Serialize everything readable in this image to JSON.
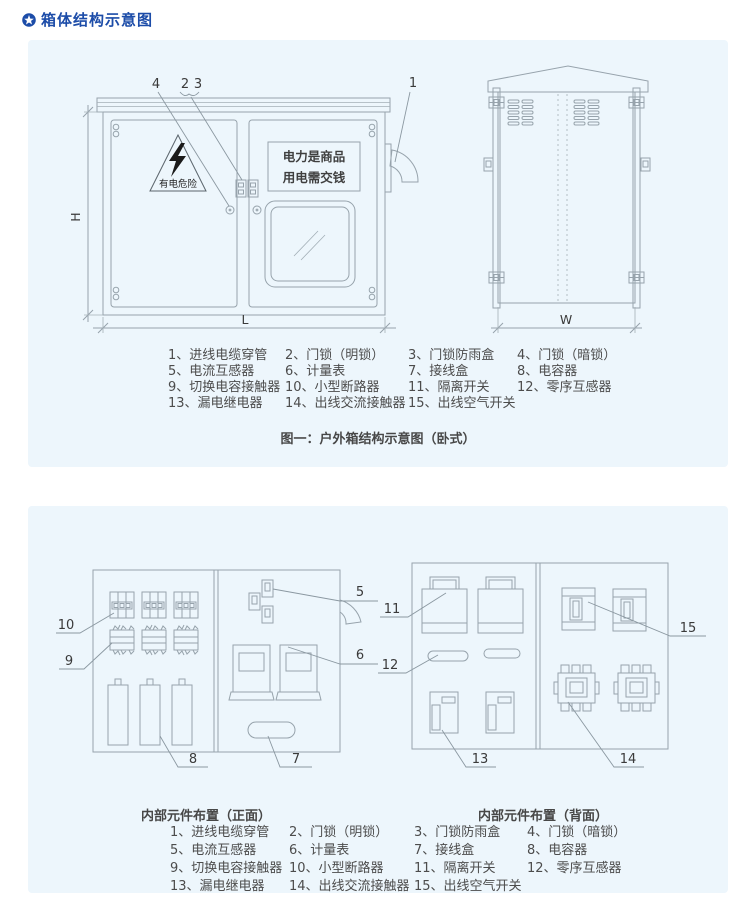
{
  "page": {
    "title": "箱体结构示意图"
  },
  "colors": {
    "accent_blue": "#1c4ca8",
    "panel_bg": "#edf6fc",
    "line_gray": "#97a3ac"
  },
  "figure1": {
    "caption": "图一：户外箱结构示意图（卧式）",
    "warning_text": "有电危险",
    "sign_line1": "电力是商品",
    "sign_line2": "用电需交钱",
    "dims": {
      "h": "H",
      "l": "L",
      "w": "W"
    },
    "callouts": {
      "c1": "1",
      "c2": "2",
      "c3": "3",
      "c4": "4"
    }
  },
  "figure2": {
    "caption_front": "内部元件布置（正面）",
    "caption_back": "内部元件布置（背面）",
    "callouts": {
      "c5": "5",
      "c6": "6",
      "c7": "7",
      "c8": "8",
      "c9": "9",
      "c10": "10",
      "c11": "11",
      "c12": "12",
      "c13": "13",
      "c14": "14",
      "c15": "15"
    }
  },
  "legend": {
    "items": [
      "1、进线电缆穿管",
      "2、门锁（明锁）",
      "3、门锁防雨盒",
      "4、门锁（暗锁）",
      "5、电流互感器",
      "6、计量表",
      "7、接线盒",
      "8、电容器",
      "9、切换电容接触器",
      "10、小型断路器",
      "11、隔离开关",
      "12、零序互感器",
      "13、漏电继电器",
      "14、出线交流接触器",
      "15、出线空气开关"
    ]
  }
}
